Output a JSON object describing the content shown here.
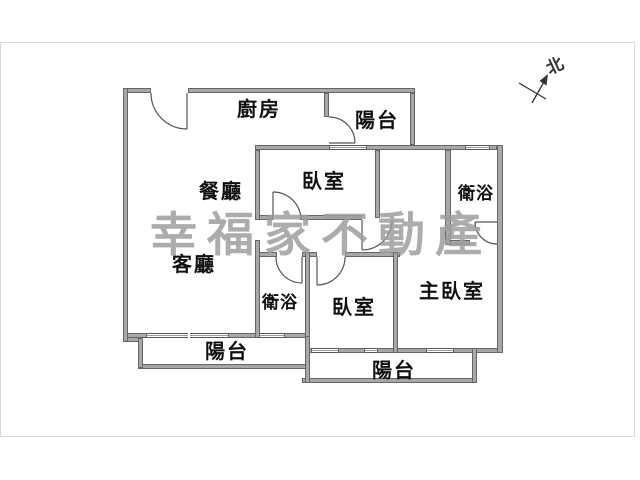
{
  "colors": {
    "background": "#ffffff",
    "panel_border": "#d9d9d9",
    "wall_fill": "#a8a8a8",
    "wall_outline": "#666666",
    "line_color": "#555555",
    "label_color": "#111111",
    "watermark_color": "#9e9e9e",
    "compass_color": "#333333"
  },
  "watermark": {
    "text": "幸福家不動產"
  },
  "compass": {
    "label": "北"
  },
  "rooms": {
    "kitchen": {
      "label": "廚房"
    },
    "balcony_top": {
      "label": "陽台"
    },
    "bedroom_top": {
      "label": "臥室"
    },
    "bath_upper": {
      "label": "衛浴"
    },
    "dining": {
      "label": "餐廳"
    },
    "living": {
      "label": "客廳"
    },
    "bath_lower": {
      "label": "衛浴"
    },
    "bedroom_bottom": {
      "label": "臥室"
    },
    "master_bedroom": {
      "label": "主臥室"
    },
    "balcony_left": {
      "label": "陽台"
    },
    "balcony_right": {
      "label": "陽台"
    }
  }
}
